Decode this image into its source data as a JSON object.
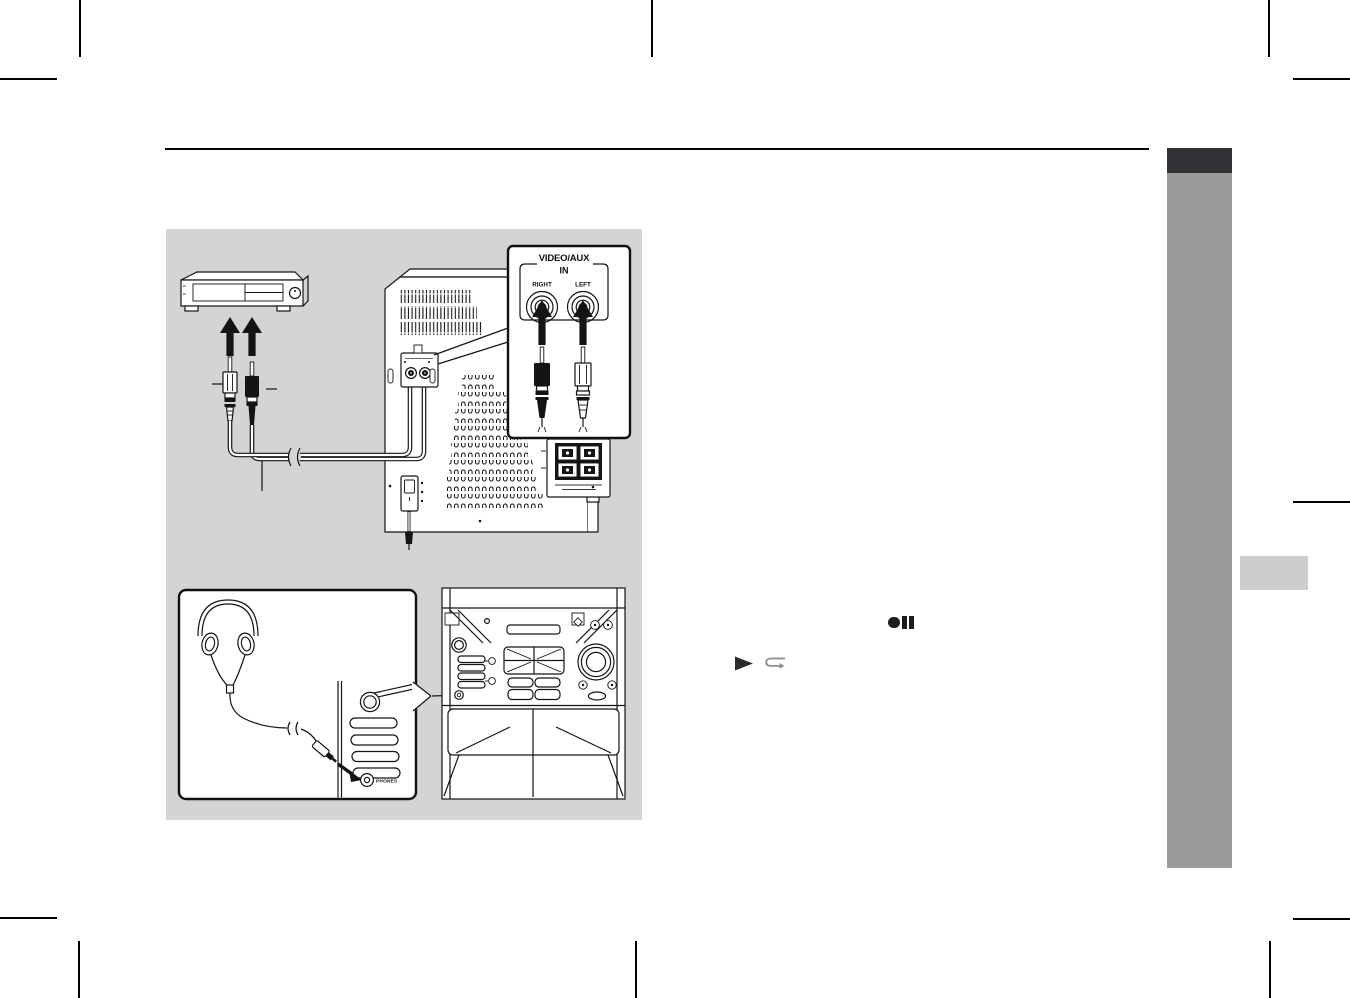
{
  "page": {
    "width": 1350,
    "height": 998,
    "background": "#ffffff"
  },
  "header": {
    "rule_color": "#000000"
  },
  "sidebar": {
    "tab_color": "#323236",
    "band_color": "#9b9b9b",
    "page_marker_color": "#cdcdcd"
  },
  "diagram_panel": {
    "background": "#d4d4d4",
    "video_aux_callout": {
      "title": "VIDEO/AUX",
      "subtitle": "IN",
      "right_jack_label": "RIGHT",
      "left_jack_label": "LEFT"
    },
    "headphones_callout": {
      "phones_jack_label": "PHONES"
    }
  },
  "inline_icons": {
    "record_pause": {
      "icon": "record-pause-icon",
      "color": "#1d1d1d"
    },
    "play": {
      "icon": "play-icon",
      "color": "#2b2b2b"
    },
    "tape_direction": {
      "icon": "tape-direction-icon",
      "color": "#8f8f8f"
    }
  }
}
